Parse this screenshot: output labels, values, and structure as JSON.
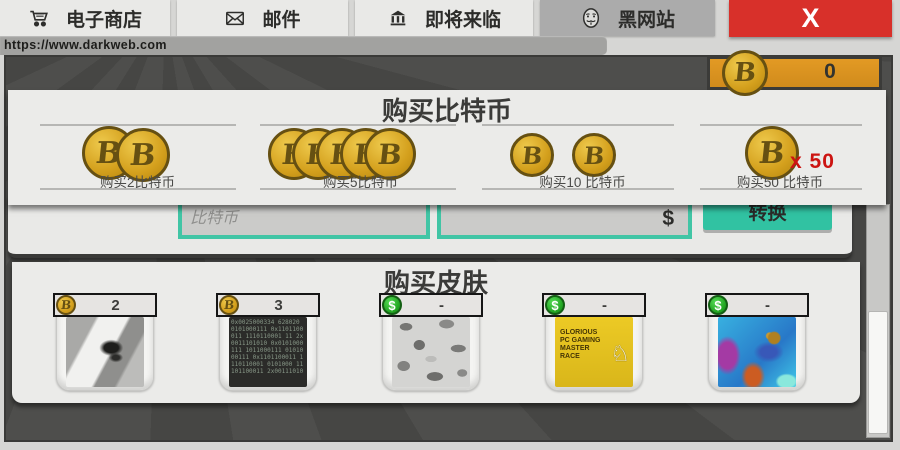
{
  "browser": {
    "tabs": [
      {
        "label": "电子商店",
        "icon": "cart-icon"
      },
      {
        "label": "邮件",
        "icon": "mail-icon"
      },
      {
        "label": "即将来临",
        "icon": "bank-icon"
      },
      {
        "label": "黑网站",
        "icon": "mask-icon"
      }
    ],
    "close_label": "X",
    "url": "https://www.darkweb.com"
  },
  "wallet": {
    "balance": "0",
    "coin_symbol": "B"
  },
  "buy_bitcoin": {
    "title": "购买比特币",
    "coin_symbol": "B",
    "options": [
      {
        "label": "购买2比特币",
        "coin_count": 2,
        "badge": ""
      },
      {
        "label": "购买5比特币",
        "coin_count": 5,
        "badge": ""
      },
      {
        "label": "购买10 比特币",
        "coin_count": 2,
        "badge": ""
      },
      {
        "label": "购买50 比特币",
        "coin_count": 1,
        "badge": "x 50"
      }
    ]
  },
  "converter": {
    "bitcoin_placeholder": "比特币",
    "dollar_symbol": "$",
    "convert_label": "转换"
  },
  "buy_skins": {
    "title": "购买皮肤",
    "bitcoin_symbol": "B",
    "dollar_symbol": "$",
    "items": [
      {
        "price": "2",
        "currency": "bitcoin",
        "skin_name": "gray-stripe-wolf"
      },
      {
        "price": "3",
        "currency": "bitcoin",
        "skin_name": "binary-code",
        "code_text": "0x0025000334 628020 0101000111 0x1101100011 1110110001 11 2x0011101010 0x0101000111 1011000111 0101000111 0x1101100011 1110110001 0101000 11101100011 2x00111010"
      },
      {
        "price": "-",
        "currency": "dollar",
        "skin_name": "gray-camo"
      },
      {
        "price": "-",
        "currency": "dollar",
        "skin_name": "pc-master-race",
        "art_text": "GLORIOUS PC GAMING MASTER RACE",
        "figure_glyph": "♘"
      },
      {
        "price": "-",
        "currency": "dollar",
        "skin_name": "hyper-beast"
      }
    ]
  },
  "colors": {
    "accent_teal": "#31c2a2",
    "bitcoin_gold": "#d4a01d",
    "counter_orange": "#dd9520",
    "close_red": "#d8302a",
    "badge_red": "#cc1411",
    "panel_gray": "#ebebe9",
    "window_dark": "#4b4b49"
  }
}
